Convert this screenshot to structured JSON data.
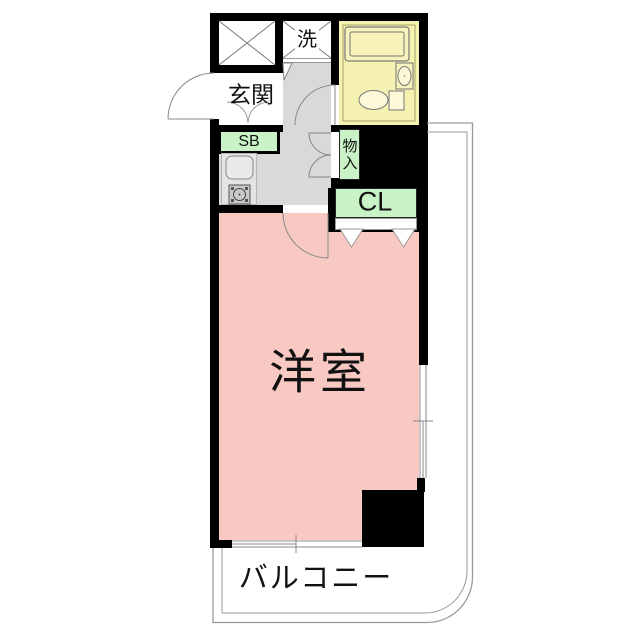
{
  "plan": {
    "rooms": {
      "western_room": {
        "label": "洋室"
      },
      "balcony": {
        "label": "バルコニー"
      },
      "entrance": {
        "label": "玄関"
      },
      "laundry": {
        "label": "洗"
      },
      "shoe_box": {
        "label": "SB"
      },
      "storage": {
        "label": "物入"
      },
      "closet": {
        "label": "CL"
      }
    },
    "colors": {
      "room_pink": "#f8c8c3",
      "bath_yellow": "#f5f1b0",
      "storage_green": "#c9f2c6",
      "floor_gray": "#d9d9d9",
      "wall_black": "#000000",
      "outline_gray": "#9a9a9a"
    }
  }
}
